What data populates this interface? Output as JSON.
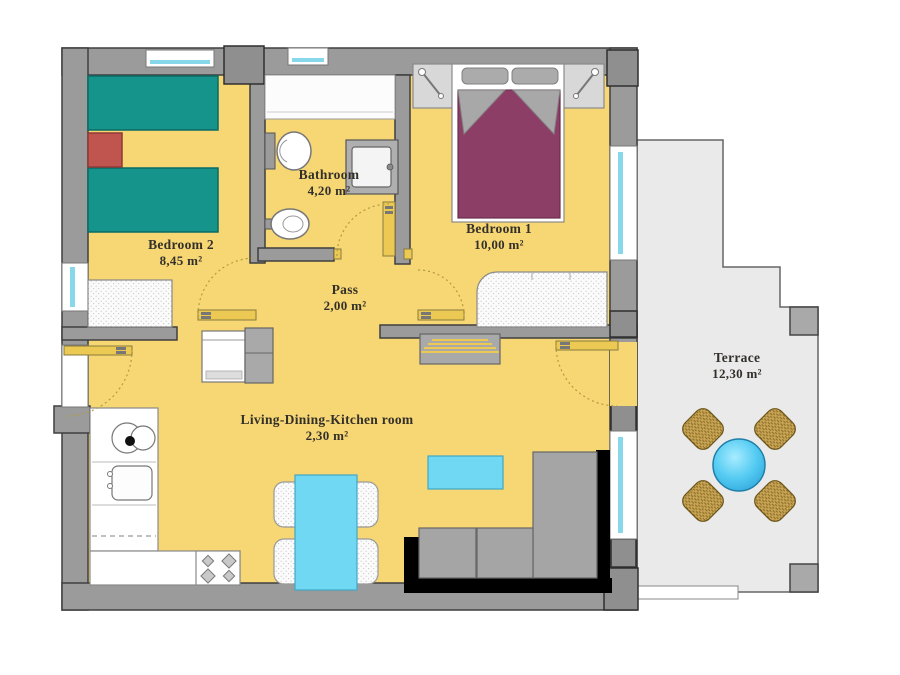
{
  "title": "Apartment floor plan",
  "rooms": [
    {
      "name": "Bedroom 2",
      "area": "8,45 m²"
    },
    {
      "name": "Bathroom",
      "area": "4,20 m²"
    },
    {
      "name": "Bedroom 1",
      "area": "10,00 m²"
    },
    {
      "name": "Pass",
      "area": "2,00 m²"
    },
    {
      "name": "Living-Dining-Kitchen room",
      "area": "2,30 m²"
    },
    {
      "name": "Terrace",
      "area": "12,30 m²"
    }
  ],
  "colors": {
    "floor_yellow": "#F7D774",
    "wall_gray": "#9B9B9B",
    "wall_outline": "#3F3F3F",
    "column_gray": "#8F8F8F",
    "terrace_floor": "#EAEAEA",
    "window_glazing": "#86D8EA",
    "door_leaf_yellow": "#EBC952",
    "bed_teal": "#15948C",
    "nightstand_red": "#C0544E",
    "bed_purple": "#8C3E66",
    "pillow_gray": "#ABABAB",
    "dining_table_cyan": "#70D8F2",
    "terrace_table_blue": "#4FC4EE",
    "rattan_chair_tan": "#C9A557",
    "sofa_black": "#000000",
    "sofa_cushion_gray": "#A5A5A5",
    "label_text": "#33302b"
  },
  "furniture": [
    "twin-bed",
    "twin-bed",
    "red-nightstand",
    "wardrobe-bedroom2",
    "window",
    "entrance-door",
    "toilet",
    "bidet",
    "washbasin",
    "shower-enclosure",
    "bathroom-door",
    "double-bed",
    "pillow",
    "pillow",
    "nightstand-with-lamp",
    "nightstand-with-lamp",
    "wardrobe-bedroom1",
    "washing-machine",
    "utility-cabinet",
    "tv-cabinet",
    "kitchen-counter",
    "hob-circles",
    "kitchen-sink",
    "dishwasher",
    "stove-4-burners",
    "dining-table",
    "dining-chair",
    "dining-chair",
    "dining-chair",
    "dining-chair",
    "coffee-table",
    "corner-sofa",
    "terrace-round-table",
    "terrace-chair",
    "terrace-chair",
    "terrace-chair",
    "terrace-chair",
    "terrace-step"
  ]
}
